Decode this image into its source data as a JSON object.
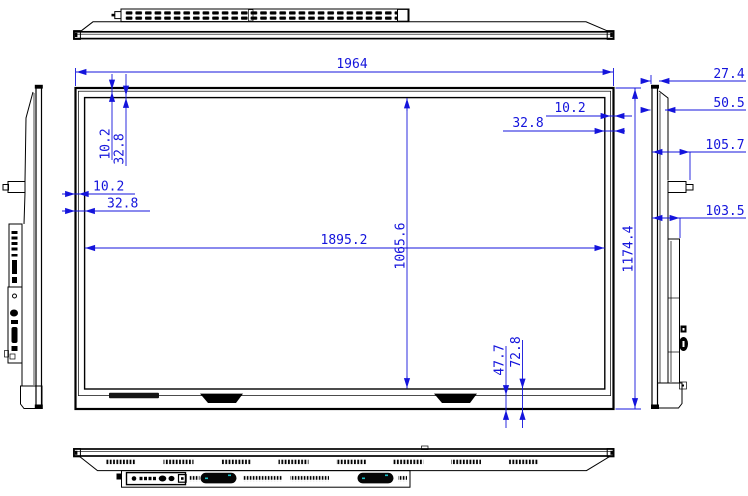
{
  "drawing": {
    "title": "display-panel-dimension-drawing",
    "colors": {
      "line_black": "#000000",
      "dimension_blue": "#1414dc",
      "speaker_accent_teal": "#19c0c8",
      "background": "#ffffff"
    },
    "dims": {
      "overall_width": "1964",
      "active_width": "1895.2",
      "active_height": "1065.6",
      "overall_height": "1174.4",
      "bezel_top_inner": "10.2",
      "bezel_top_outer": "32.8",
      "bezel_left_inner": "10.2",
      "bezel_left_outer": "32.8",
      "bezel_right_inner": "10.2",
      "bezel_right_outer": "32.8",
      "bezel_bottom_inner": "47.7",
      "bezel_bottom_outer": "72.8",
      "depth_glass": "27.4",
      "depth_front_section": "50.5",
      "depth_with_button": "105.7",
      "depth_back_section": "103.5"
    }
  }
}
